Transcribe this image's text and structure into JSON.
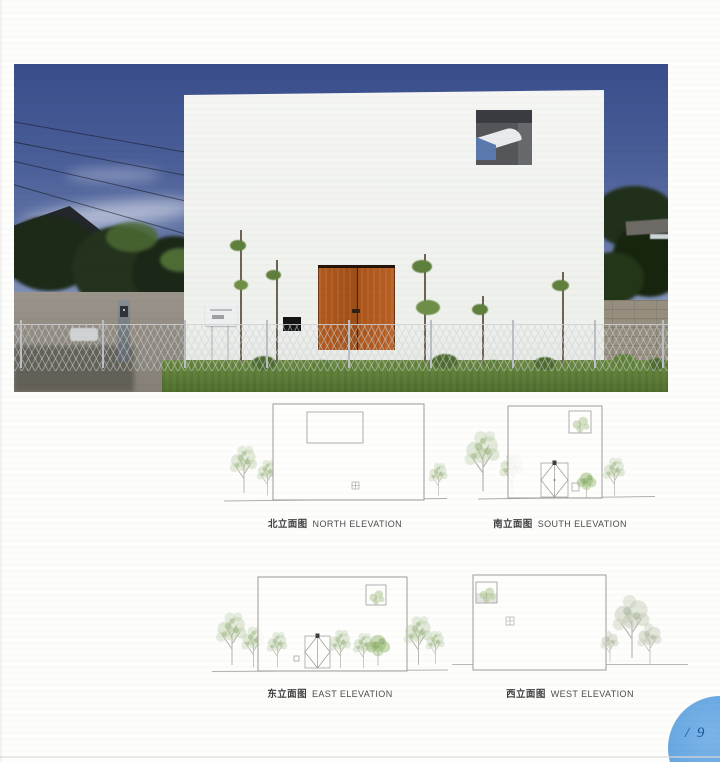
{
  "photo": {
    "colors": {
      "sky_top": "#394d8c",
      "sky_horizon": "#b3bdd3",
      "facade": "#f3f4f1",
      "door": "#a9541a",
      "grass": "#5d7c38",
      "block_wall": "#968e7e"
    }
  },
  "elevations": [
    {
      "label_cn": "北立面图",
      "label_en": "NORTH ELEVATION"
    },
    {
      "label_cn": "南立面图",
      "label_en": "SOUTH ELEVATION"
    },
    {
      "label_cn": "东立面图",
      "label_en": "EAST ELEVATION"
    },
    {
      "label_cn": "西立面图",
      "label_en": "WEST ELEVATION"
    }
  ],
  "page_badge": {
    "label": "/ 9",
    "circle_color": "#68a8e2",
    "text_color": "#1b579b"
  }
}
